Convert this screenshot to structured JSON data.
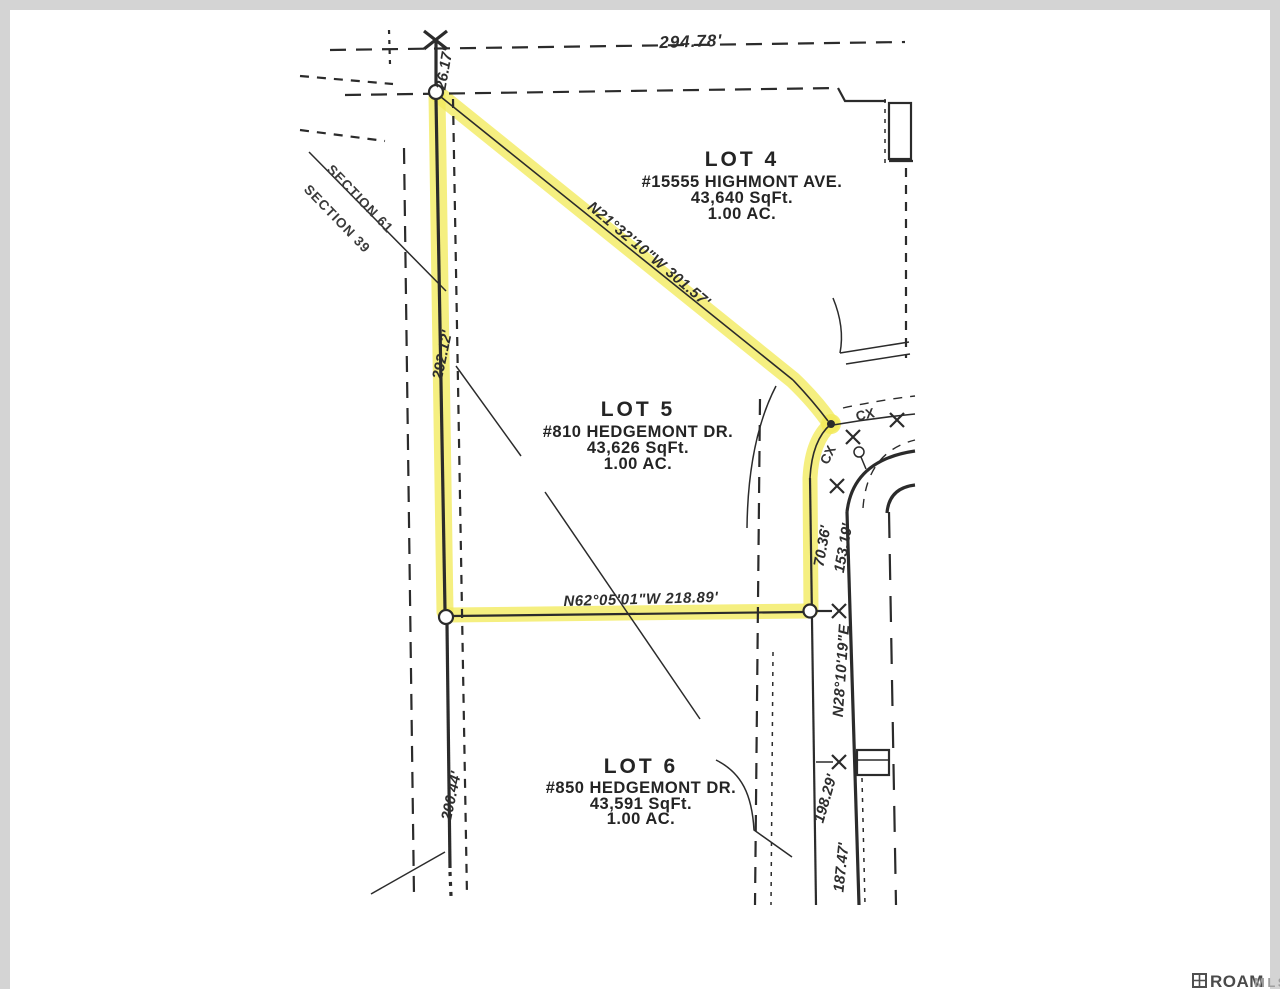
{
  "colors": {
    "highlight": "#f2ea5c",
    "ink": "#2b2b2b",
    "paper": "#ffffff",
    "margin": "#d4d4d4"
  },
  "plat": {
    "lots": [
      {
        "name": "LOT 4",
        "address": "#15555 HIGHMONT AVE.",
        "area_sqft": "43,640 SqFt.",
        "area_acres": "1.00 AC."
      },
      {
        "name": "LOT 5",
        "address": "#810 HEDGEMONT DR.",
        "area_sqft": "43,626 SqFt.",
        "area_acres": "1.00 AC."
      },
      {
        "name": "LOT 6",
        "address": "#850 HEDGEMONT DR.",
        "area_sqft": "43,591 SqFt.",
        "area_acres": "1.00 AC."
      }
    ],
    "dimensions": {
      "top_line": "294.78'",
      "corner_tick": "26.17'",
      "west_upper": "292.12'",
      "west_lower": "200.44'",
      "east_curve": "70.36'",
      "east_upper": "153.19'",
      "east_lower": "198.29'",
      "east_bottom": "187.47'"
    },
    "bearings": {
      "north_line": "N21°32'10\"W 301.57'",
      "south_line": "N62°05'01\"W 218.89'",
      "east_line": "N28°10'19\"E"
    },
    "annotations": {
      "section_line_upper": "SECTION 61",
      "section_line_lower": "SECTION 39",
      "curve_mark_1": "CX",
      "curve_mark_2": "CX"
    }
  },
  "watermark": {
    "brand": "ROAM",
    "suffix": "MLS"
  }
}
